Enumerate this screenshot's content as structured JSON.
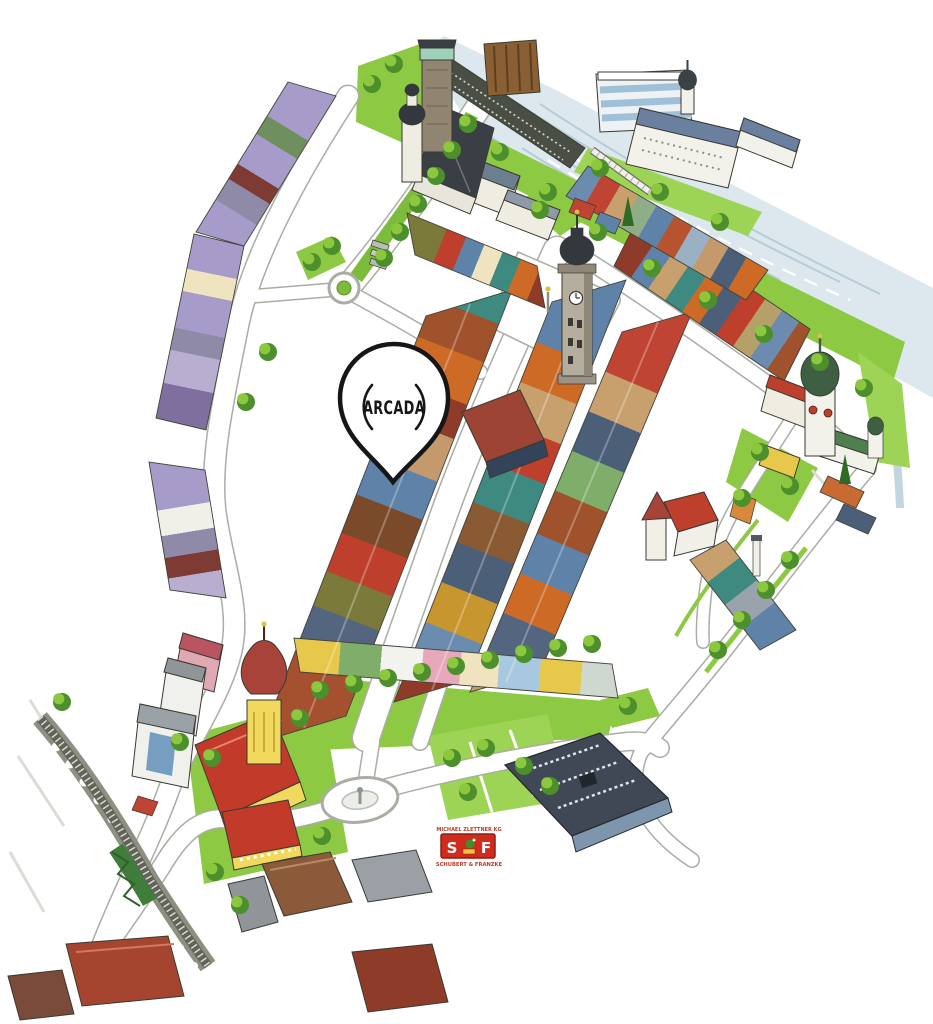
{
  "marker": {
    "label": "ARCADA"
  },
  "credits": {
    "artist_line": "MICHAEL ZLETTNER KG",
    "publisher_logo_left": "S",
    "publisher_logo_right": "F",
    "publisher_line": "SCHUBERT & FRANZKE"
  },
  "palette": {
    "paper": "#ffffff",
    "water": "#dce8ee",
    "water_streak": "#b2c9d6",
    "lawn": "#8ec943",
    "tree_dark": "#4c8f2c",
    "tree_light": "#8bc83e",
    "road_casing": "#a9ada3",
    "roof_red": "#bf3f2d",
    "roof_orange": "#cc6a26",
    "roof_blue": "#5f83a8",
    "roof_teal": "#3e8a80",
    "roof_purple": "#a79cc9",
    "roof_charcoal": "#3f4854",
    "church_yellow": "#f0d95c",
    "marker_ink": "#161616",
    "logo_red": "#cf2b1e",
    "credit_red": "#c03a28"
  },
  "features": [
    {
      "name": "castle-and-church-complex"
    },
    {
      "name": "river"
    },
    {
      "name": "footbridge"
    },
    {
      "name": "city-clock-tower"
    },
    {
      "name": "main-square-house-rows"
    },
    {
      "name": "onion-dome-church-east"
    },
    {
      "name": "parish-church-southwest"
    },
    {
      "name": "railway-viaduct"
    },
    {
      "name": "roundabout-south"
    },
    {
      "name": "roundabout-north"
    },
    {
      "name": "tree-avenue"
    },
    {
      "name": "promenade-park"
    },
    {
      "name": "exhibition-hall-southeast"
    },
    {
      "name": "arcada-location-pin"
    }
  ]
}
